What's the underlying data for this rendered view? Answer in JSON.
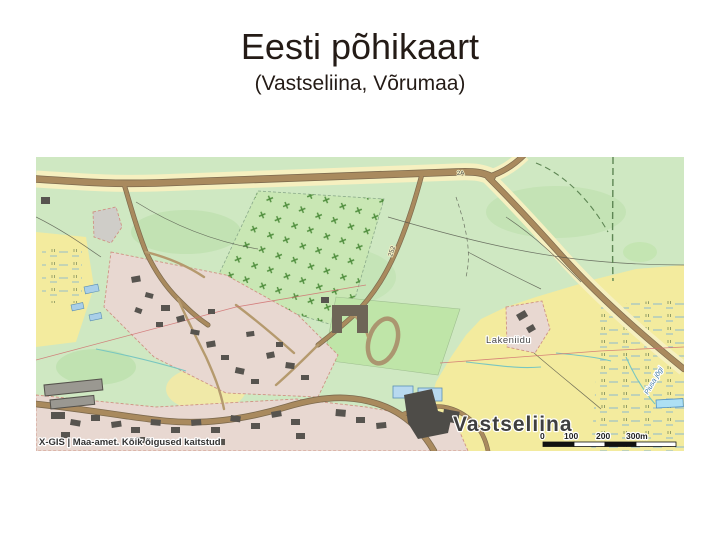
{
  "slide": {
    "title": "Eesti põhikaart",
    "subtitle": "(Vastseliina, Võrumaa)"
  },
  "map": {
    "place_labels": {
      "town": "Vastseliina",
      "farm": "Lakeniidu",
      "river": "Piusa jõgi"
    },
    "road_labels": {
      "number": "2A",
      "kilometer": "252"
    },
    "attribution": "X-GIS | Maa-amet. Kõik õigused kaitstud",
    "scale_bar": {
      "ticks": [
        "0",
        "100",
        "200",
        "300m"
      ]
    },
    "colors": {
      "grass_green": "#cfe8c2",
      "field_yellow": "#f3eb9e",
      "road_brown": "#a98a5e",
      "builtup_pink": "#e8d8d1",
      "water_blue": "#aee0f4",
      "title_text": "#241b16"
    }
  }
}
